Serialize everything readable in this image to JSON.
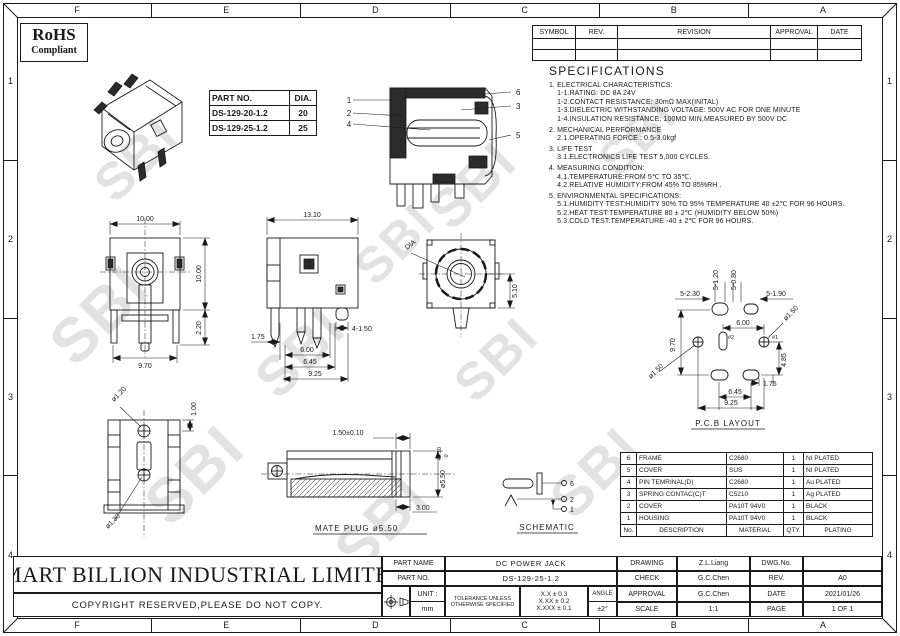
{
  "zones": {
    "columns": [
      "F",
      "E",
      "D",
      "C",
      "B",
      "A"
    ],
    "rows": [
      "1",
      "2",
      "3",
      "4"
    ]
  },
  "rohs": {
    "title": "RoHS",
    "subtitle": "Compliant"
  },
  "part_table": {
    "col1": "PART NO.",
    "col2": "DIA.",
    "rows": [
      {
        "part": "DS-129-20-1.2",
        "dia": "20"
      },
      {
        "part": "DS-129-25-1.2",
        "dia": "25"
      }
    ]
  },
  "revision_table": {
    "headers": [
      "SYMBOL",
      "REV.",
      "REVISION",
      "APPROVAL",
      "DATE"
    ]
  },
  "specs": {
    "title": "SPECIFICATIONS",
    "lines": [
      "1. ELECTRICAL CHARACTERISTICS:",
      "    1-1.RATING: DC 8A 24V",
      "    1-2.CONTACT RESISTANCE: 30mΩ MAX(INITAL)",
      "    1-3.DIELECTRIC WITHSTANDING VOLTAGE: 500V AC FOR ONE MINUTE",
      "    1-4.INSULATION RESISTANCE: 100MΩ MIN,MEASURED BY 500V DC",
      "2. MECHANICAL PERFORMANCE",
      "    2.1.OPERATING FORCE : 0.5-3.0kgf",
      "3. LIFE TEST",
      "    3.1.ELECTRONICS LIFE TEST 5,000 CYCLES.",
      "4. MEASURING CONDITION:",
      "    4.1.TEMPERATURE:FROM 5℃ TO 35℃.",
      "    4.2.RELATIVE HUMIDITY:FROM 45% TO 85%RH .",
      "5. ENVIRONMENTAL SPECIFICATIONS:",
      "    5.1.HUMIDITY TEST:HUMIDITY 90% TO 95% TEMPERATURE 40 ±2℃ FOR 96 HOURS.",
      "    5.2.HEAT TEST:TEMPERATURE 80 ± 2℃ (HUMIDITY BELOW 50%)",
      "    5.3.COLD TEST:TEMPERATURE -40 ± 2℃ FOR 96 HOURS."
    ]
  },
  "section_view": {
    "callout_1": "1",
    "callout_2": "2",
    "callout_4": "4",
    "callout_6": "6",
    "callout_3": "3",
    "callout_5": "5"
  },
  "views": {
    "front": {
      "dim_width_top": "10.00",
      "dim_height": "10.00",
      "dim_width_bottom": "9.70",
      "dim_leg": "2.20"
    },
    "side": {
      "dim_width_top": "13.10",
      "dim_pins": "4-1.50",
      "dim_left": "1.75",
      "dim_a": "6.00",
      "dim_b": "6.45",
      "dim_c": "9.25"
    },
    "rear": {
      "dia_label": "DIA",
      "dim_height": "5.10"
    },
    "bottom": {
      "dim_pin_top": "ø1.20",
      "dim_offset": "1.00",
      "dim_pin_bottom": "ø1.30"
    },
    "pcb": {
      "title": "P.C.B LAYOUT",
      "dim_slot_v1": "5-1.20",
      "dim_slot_v2": "5-0.80",
      "dim_slot_left": "5-2.30",
      "dim_slot_right": "5-1.90",
      "dim_span": "6.00",
      "hole_right": "ø1.50",
      "hole_left": "ø1.50",
      "pin1": "#1",
      "pin2": "#2",
      "dim_height": "9.70",
      "dim_right_a": "4.85",
      "dim_right_b": "1.75",
      "dim_bottom_a": "6.45",
      "dim_bottom_b": "9.25"
    },
    "mate_plug": {
      "title": "MATE PLUG ø5.50",
      "dim_ring": "1.50±0.10",
      "dim_dia": "ø5.50",
      "tol_upper": "+0.10",
      "tol_lower": "0",
      "dim_tip": "3.00"
    },
    "schematic": {
      "title": "SCHEMATIC",
      "pins": [
        "6",
        "2",
        "1"
      ]
    }
  },
  "materials": {
    "headers": {
      "no": "No.",
      "description": "DESCRIPTION",
      "material": "MATERIAL",
      "qty": "QTY.",
      "plating": "PLATING"
    },
    "rows": [
      {
        "no": "6",
        "desc": "FRAME",
        "mat": "C2680",
        "qty": "1",
        "plating": "NI PLATED"
      },
      {
        "no": "5",
        "desc": "COVER",
        "mat": "SUS",
        "qty": "1",
        "plating": "NI PLATED"
      },
      {
        "no": "4",
        "desc": "PIN TEMRINAL(D)",
        "mat": "C2680",
        "qty": "1",
        "plating": "Au PLATED"
      },
      {
        "no": "3",
        "desc": "SPRING CONTAC(C)T",
        "mat": "C5210",
        "qty": "1",
        "plating": "Ag PLATED"
      },
      {
        "no": "2",
        "desc": "COVER",
        "mat": "PA10T 94V0",
        "qty": "1",
        "plating": "BLACK"
      },
      {
        "no": "1",
        "desc": "HOUSING",
        "mat": "PA10T 94V0",
        "qty": "1",
        "plating": "BLACK"
      }
    ]
  },
  "title_block": {
    "company": "SMART BILLION INDUSTRIAL LIMITED",
    "copyright": "COPYRIGHT RESERVED,PLEASE DO NOT COPY.",
    "part_name_label": "PART NAME",
    "part_name": "DC POWER JACK",
    "part_no_label": "PART NO.",
    "part_no": "DS-129-25-1.2",
    "unit_label": "UNIT :",
    "unit_value": "mm",
    "tolerance_note_1": "TOLERANCE UNLESS",
    "tolerance_note_2": "OTHERWISE SPECIFIED",
    "tol_1": "X.X ± 0.3",
    "tol_2": "X.XX ± 0.2",
    "tol_3": "X.XXX ± 0.1",
    "angle_label": "ANGLE",
    "angle_value": "±2°",
    "drawing_label": "DRAWING",
    "drawing": "Z.L.Liang",
    "check_label": "CHECK",
    "check": "G.C.Chen",
    "approval_label": "APPROVAL",
    "approval": "G.C.Chen",
    "scale_label": "SCALE",
    "scale": "1:1",
    "dwg_no_label": "DWG.No.",
    "dwg_no": "",
    "rev_label": "REV.",
    "rev": "A0",
    "date_label": "DATE",
    "date": "2021/01/26",
    "page_label": "PAGE",
    "page": "1 OF 1"
  },
  "watermark": {
    "text": "SBI"
  }
}
